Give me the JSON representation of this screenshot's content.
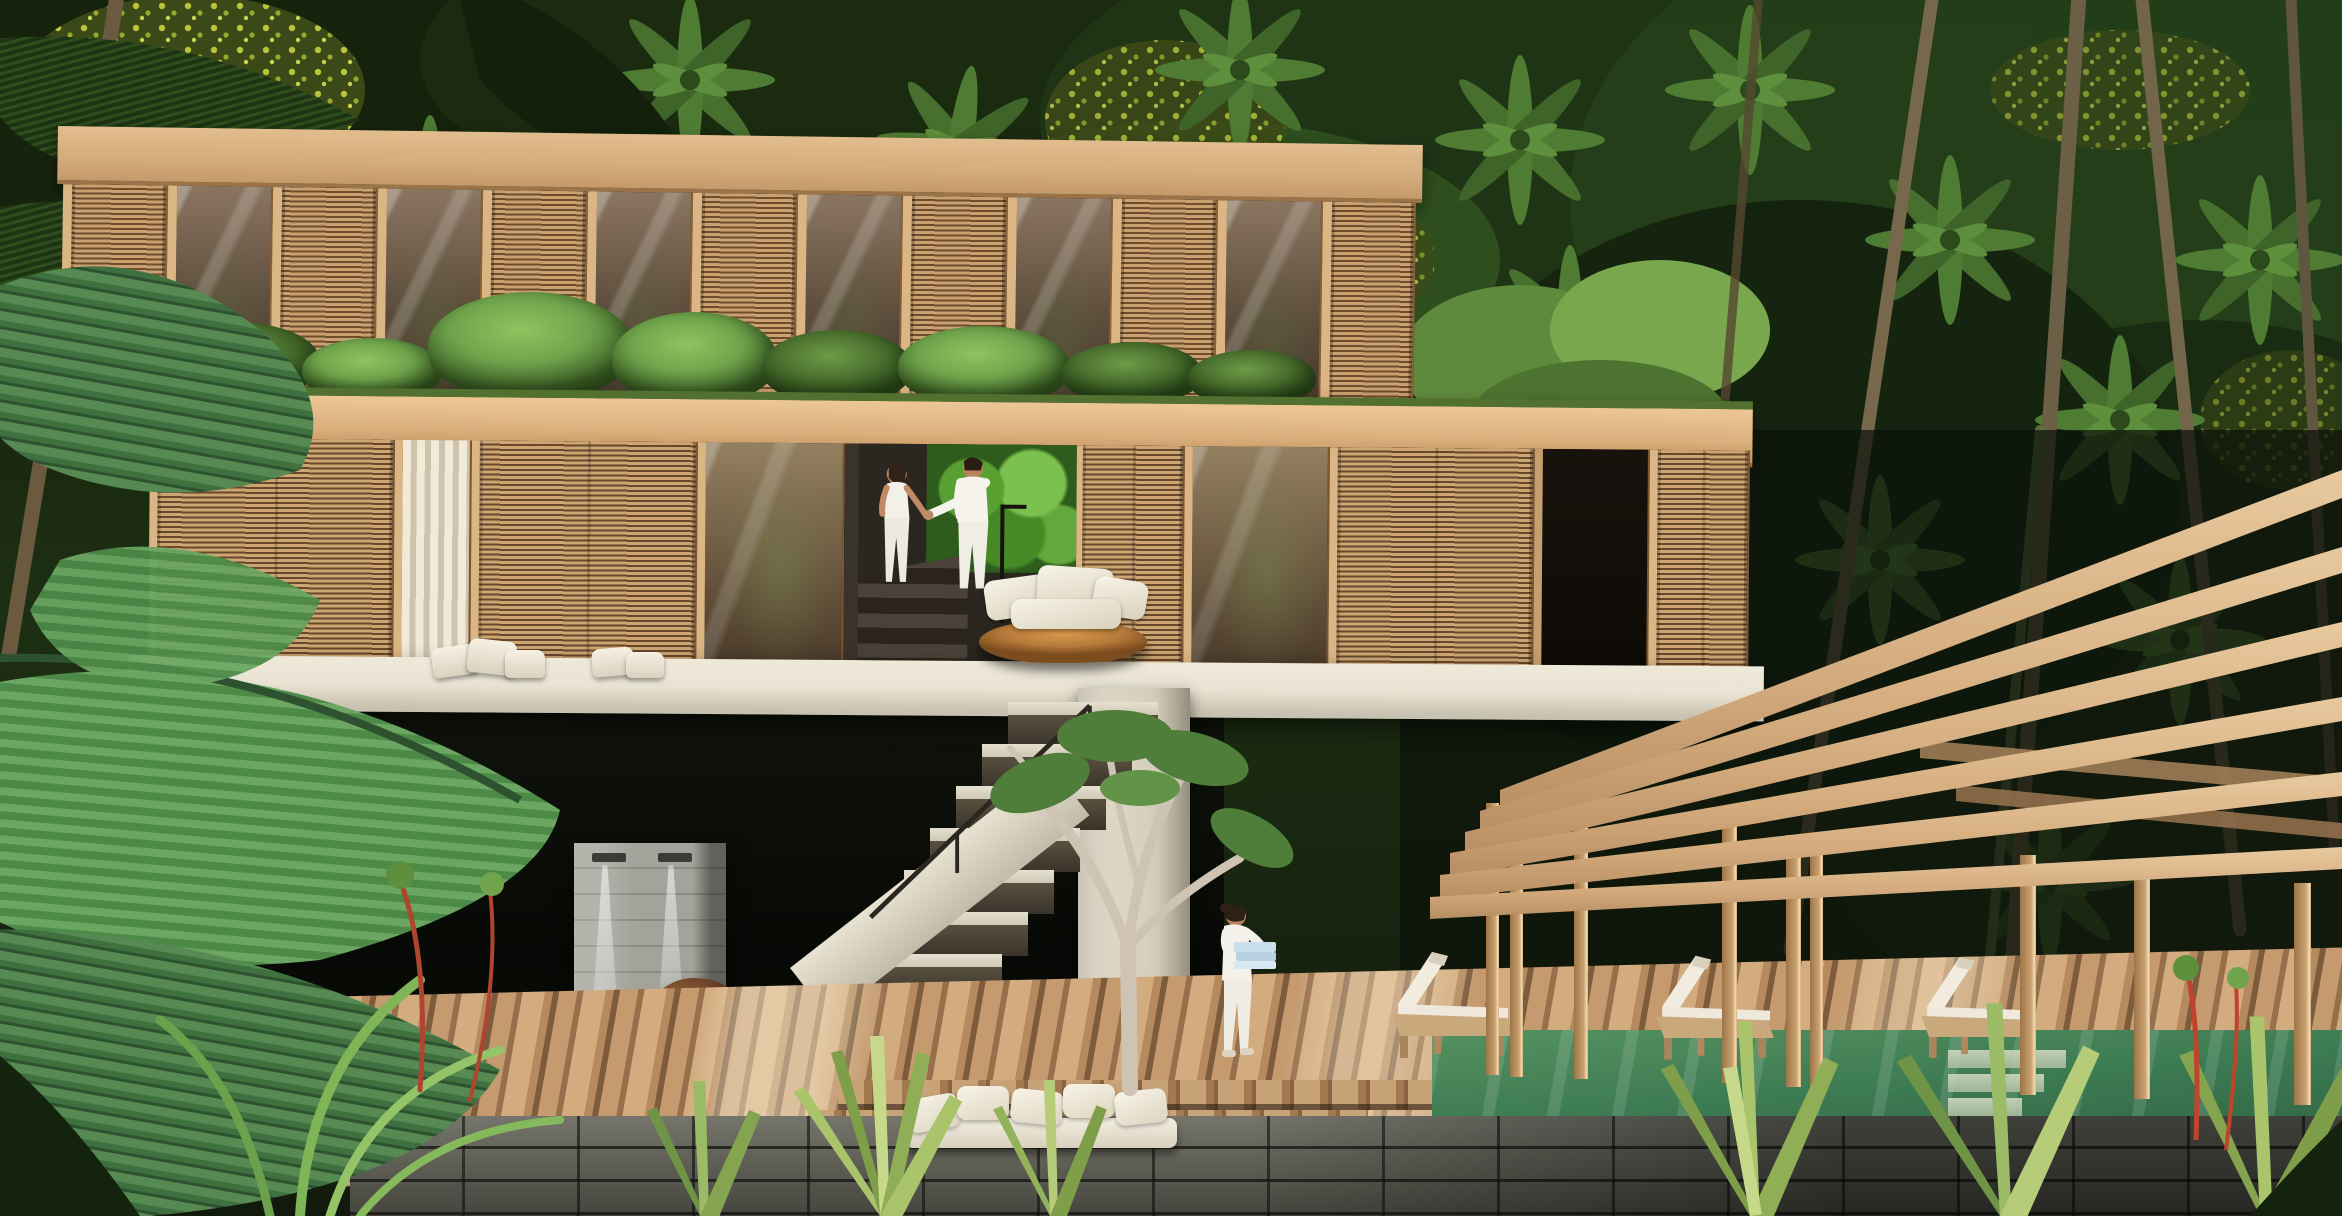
{
  "scene": {
    "title": "tropical-jungle-villa-rendering",
    "type": "architectural visualization, no text present",
    "description": "Two-storey timber villa with vertical slatted shutters and glass, built into a jungle hillside. A couple in white descends interior stairs past a round daybed; below, an undercroft with a stone outdoor-shower column, boulder and gravel bed meets a diagonal timber pool deck. A staff member in white carries folded blue towels toward a green infinity pool shaded by an inclined timber pergola with three sun loungers. Dense palms, ferns and flowering canopy surround everything.",
    "figures": [
      {
        "name": "couple-woman",
        "clothing": "white tank top and trousers",
        "hair": "dark, tied back",
        "action": "walking down stairs holding hands"
      },
      {
        "name": "couple-man",
        "clothing": "white long-sleeve shirt and trousers",
        "hair": "dark",
        "action": "walking down stairs holding hands"
      },
      {
        "name": "staff-member",
        "clothing": "white uniform",
        "action": "carrying a stack of folded light-blue towels across the deck",
        "facing": "right"
      }
    ],
    "objects": {
      "sun_loungers": 3,
      "shower_heads": 2,
      "pergola_beams": 6,
      "pergola_posts": 9,
      "round_daybed": 1,
      "deck_sofa_cushions": 5,
      "ledge_pillows": 5,
      "boulder": 1,
      "plumeria_tree": 1,
      "pool_steps": 3
    },
    "palette": {
      "canopy_dark": "#141f0d",
      "canopy_mid": "#2e4a20",
      "leaf_light": "#6fa44c",
      "leaf_bright": "#8fc45f",
      "flower_yellow": "#c3cc3d",
      "wood_light": "#e2bd8e",
      "wood_mid": "#c59a6a",
      "wood_dark": "#8a6038",
      "glass_warm": "#8a7560",
      "glass_dark": "#42362a",
      "slab_white": "#e9e3d3",
      "stone_light": "#a3a39b",
      "stone_dark": "#55554e",
      "deck_light": "#d2ab7e",
      "deck_dark": "#7d5c3d",
      "pool_green": "#3c7a52",
      "pool_deep": "#2c5f3f",
      "cushion_white": "#f1ece0",
      "towel_blue": "#c9dfec",
      "skin": "#c08a67",
      "hair_dark": "#32231a",
      "leafwall_green": "#59a032",
      "beam_lit": "#e8c99e",
      "beam_shade": "#b68e63"
    }
  }
}
